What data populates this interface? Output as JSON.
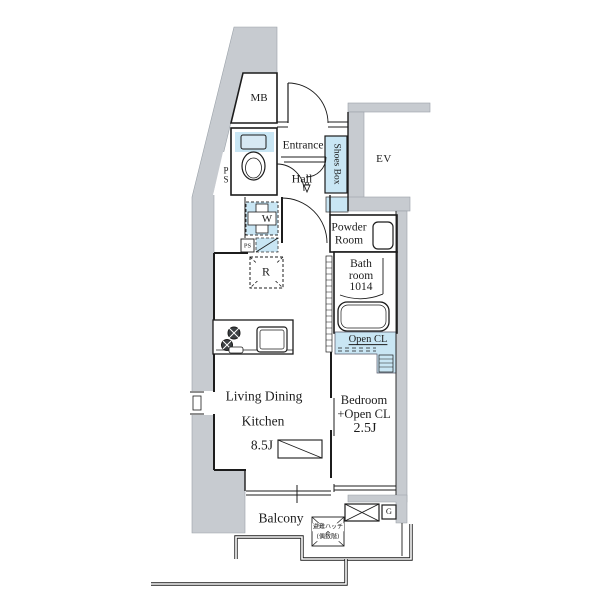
{
  "colors": {
    "wall_gray": "#c7cbd0",
    "floor_highlight_blue": "#c9e6f4",
    "line_black": "#1c1c1c"
  },
  "plan": {
    "rooms": {
      "meter_box": {
        "label": "MB"
      },
      "pipe_shaft": {
        "label": "P\nS"
      },
      "entrance": {
        "label": "Entrance"
      },
      "hall": {
        "label": "Hall"
      },
      "shoes_box": {
        "label": "Shoes Box"
      },
      "elevator": {
        "label": "EV"
      },
      "powder_room": {
        "label": "Powder\nRoom"
      },
      "bathroom": {
        "label": "Bath\nroom\n1014"
      },
      "open_closet": {
        "label": "Open CL"
      },
      "living_dining_kitchen": {
        "line1": "Living Dining",
        "line2": "Kitchen",
        "size": "8.5J"
      },
      "bedroom": {
        "line1": "Bedroom",
        "line2": "+Open CL",
        "size": "2.5J"
      },
      "balcony": {
        "label": "Balcony"
      }
    },
    "fixtures": {
      "washing_machine": {
        "label": "W"
      },
      "pipe_space_small": {
        "label": "PS"
      },
      "refrigerator": {
        "label": "R"
      },
      "gas_meter": {
        "label": "G"
      },
      "evacuation_hatch": {
        "line1": "避難ハッチ",
        "line2": "(偶数階)"
      }
    }
  }
}
